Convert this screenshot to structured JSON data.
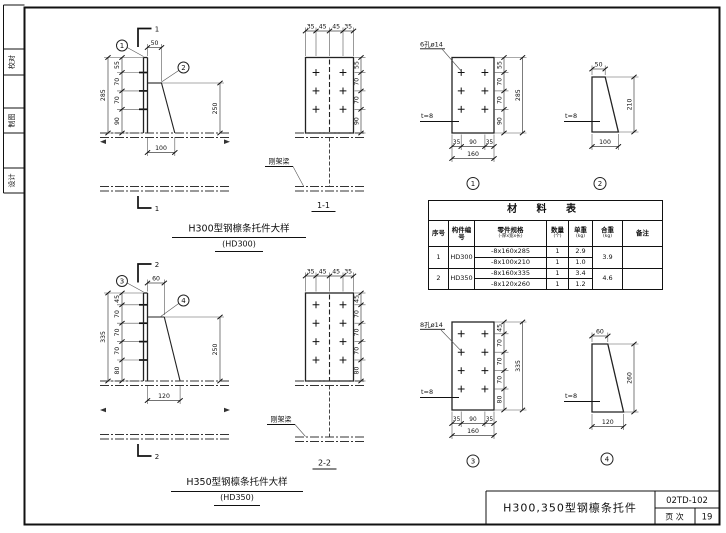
{
  "sidebar": {
    "items": [
      {
        "label": "校对"
      },
      {
        "label": "制图"
      },
      {
        "label": "设计"
      }
    ]
  },
  "h300": {
    "title": "H300型钢檩条托件大样",
    "subtitle": "(HD300)",
    "elev": {
      "section_mark": "1",
      "balloon_plate": "1",
      "balloon_gusset": "2",
      "dim_top": "50",
      "dim_total": "285",
      "dim_segs": [
        "55",
        "70",
        "70",
        "90"
      ],
      "dim_right": "250",
      "dim_bottom": "100"
    },
    "section": {
      "caption": "1-1",
      "beam_label": "刚架梁",
      "dims_top": [
        "35",
        "45",
        "45",
        "35"
      ],
      "dims_right": [
        "55",
        "70",
        "70",
        "90"
      ]
    },
    "detail_plate": {
      "caption": "1",
      "holes_label": "6孔ø14",
      "thickness": "t=8",
      "dims_right": [
        "55",
        "70",
        "70",
        "90"
      ],
      "dim_right_total": "285",
      "dims_bottom": [
        "35",
        "90",
        "35"
      ],
      "dim_bottom_total": "160"
    },
    "detail_gusset": {
      "caption": "2",
      "dim_top": "50",
      "dim_height": "210",
      "dim_bottom": "100",
      "thickness": "t=8"
    }
  },
  "h350": {
    "title": "H350型钢檩条托件大样",
    "subtitle": "(HD350)",
    "elev": {
      "section_mark": "2",
      "balloon_plate": "3",
      "balloon_gusset": "4",
      "dim_top": "60",
      "dim_total": "335",
      "dim_segs": [
        "45",
        "70",
        "70",
        "70",
        "80"
      ],
      "dim_right": "250",
      "dim_bottom": "120"
    },
    "section": {
      "caption": "2-2",
      "beam_label": "刚架梁",
      "dims_top": [
        "35",
        "45",
        "45",
        "35"
      ],
      "dims_right": [
        "45",
        "70",
        "70",
        "70",
        "80"
      ]
    },
    "detail_plate": {
      "caption": "3",
      "holes_label": "8孔ø14",
      "thickness": "t=8",
      "dims_right": [
        "45",
        "70",
        "70",
        "70",
        "80"
      ],
      "dim_right_total": "335",
      "dims_bottom": [
        "35",
        "90",
        "35"
      ],
      "dim_bottom_total": "160"
    },
    "detail_gusset": {
      "caption": "4",
      "dim_top": "60",
      "dim_height": "260",
      "dim_bottom": "120",
      "thickness": "t=8"
    }
  },
  "material_table": {
    "title": "材  料  表",
    "headers": {
      "no": "序号",
      "member": "构件编号",
      "spec": "零件规格",
      "spec_sub": "(-厚x宽x长)",
      "qty": "数量",
      "qty_sub": "(个)",
      "unit_weight": "单重",
      "unit_weight_sub": "(kg)",
      "total_weight": "合重",
      "total_weight_sub": "(kg)",
      "remark": "备注"
    },
    "rows": [
      {
        "no": "1",
        "member": "HD300",
        "total": "3.9",
        "remark": "",
        "parts": [
          {
            "spec": "-8x160x285",
            "qty": "1",
            "unit": "2.9"
          },
          {
            "spec": "-8x100x210",
            "qty": "1",
            "unit": "1.0"
          }
        ]
      },
      {
        "no": "2",
        "member": "HD350",
        "total": "4.6",
        "remark": "",
        "parts": [
          {
            "spec": "-8x160x335",
            "qty": "1",
            "unit": "3.4"
          },
          {
            "spec": "-8x120x260",
            "qty": "1",
            "unit": "1.2"
          }
        ]
      }
    ]
  },
  "title_block": {
    "title": "H300,350型钢檩条托件",
    "drawing_no": "02TD-102",
    "page_label": "页 次",
    "page_no": "19"
  }
}
